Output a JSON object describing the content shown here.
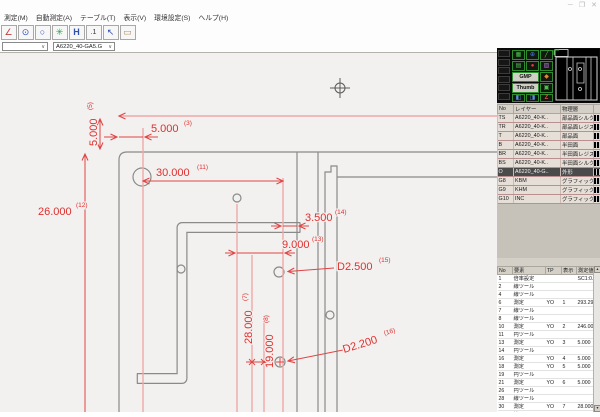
{
  "window": {
    "controls": [
      "─",
      "❐",
      "✕"
    ],
    "menu": [
      "測定(M)",
      "自動測定(A)",
      "テーブル(T)",
      "表示(V)",
      "環境設定(S)",
      "ヘルプ(H)"
    ]
  },
  "toolbar": {
    "icons": [
      {
        "name": "angle-measure-icon",
        "glyph": "∠"
      },
      {
        "name": "circle-pair-icon",
        "glyph": "⊙"
      },
      {
        "name": "circle-measure-icon",
        "glyph": "○"
      },
      {
        "name": "gear-icon",
        "glyph": "✳"
      },
      {
        "name": "horizontal-distance-icon",
        "glyph": "H"
      },
      {
        "name": "number-label-icon",
        "glyph": ".1"
      },
      {
        "name": "select-cursor-icon",
        "glyph": "↖"
      },
      {
        "name": "report-window-icon",
        "glyph": "▭"
      }
    ]
  },
  "combos": {
    "blank": "",
    "file": "A6220_40-GA5.G",
    "caret": "∨"
  },
  "drawing": {
    "dims": {
      "d3": {
        "value": "5.000",
        "idx": "(3)"
      },
      "d5": {
        "value": "5.000",
        "idx": "(5)"
      },
      "d7": {
        "value": "28.000",
        "idx": "(7)"
      },
      "d8": {
        "value": "19.000",
        "idx": "(8)"
      },
      "d11": {
        "value": "30.000",
        "idx": "(11)"
      },
      "d12": {
        "value": "26.000",
        "idx": "(12)"
      },
      "d13": {
        "value": "9.000",
        "idx": "(13)"
      },
      "d14": {
        "value": "3.500",
        "idx": "(14)"
      },
      "d15": {
        "value": "D2.500",
        "idx": "(15)"
      },
      "d16": {
        "value": "D2.200",
        "idx": "(16)"
      }
    },
    "colors": {
      "dimension": "#e02f2f",
      "extension": "#f0a8a8",
      "part": "#8a8a8a",
      "background": "#f2f1ef"
    }
  },
  "panel": {
    "buttons": {
      "gmp": "GMP",
      "thumb": "Thumb"
    },
    "cluster_icons": [
      {
        "name": "grid-icon",
        "glyph": "▦"
      },
      {
        "name": "target-icon",
        "glyph": "⊕"
      },
      {
        "name": "draw-icon",
        "glyph": "╱"
      },
      {
        "name": "doc-icon",
        "glyph": "▤"
      },
      {
        "name": "record-icon",
        "glyph": "●"
      },
      {
        "name": "palette-icon",
        "glyph": "▨"
      },
      {
        "name": "wrench-icon",
        "glyph": "◆"
      },
      {
        "name": "camera-icon",
        "glyph": "▣"
      },
      {
        "name": "up-icon",
        "glyph": "◧"
      },
      {
        "name": "down-icon",
        "glyph": "◨"
      },
      {
        "name": "zoom-icon",
        "glyph": "Z"
      }
    ],
    "layer_table": {
      "headers": [
        "No",
        "レイヤー",
        "物理層"
      ],
      "rows": [
        {
          "no": "TS",
          "layer": "A6220_40-K..",
          "phys": "部品面シルク"
        },
        {
          "no": "TR",
          "layer": "A6220_40-K..",
          "phys": "部品面レジスト"
        },
        {
          "no": "T",
          "layer": "A6220_40-K..",
          "phys": "部品面"
        },
        {
          "no": "B",
          "layer": "A6220_40-K..",
          "phys": "半田面"
        },
        {
          "no": "BR",
          "layer": "A6220_40-K..",
          "phys": "半田面レジスト"
        },
        {
          "no": "BS",
          "layer": "A6220_40-K..",
          "phys": "半田面シルク"
        },
        {
          "no": "O",
          "layer": "A6220_40-G..",
          "phys": "外形",
          "selected": true
        },
        {
          "no": "G8",
          "layer": "KBM",
          "phys": "グラフィック"
        },
        {
          "no": "G9",
          "layer": "KHM",
          "phys": "グラフィック"
        },
        {
          "no": "G10",
          "layer": "INC",
          "phys": "グラフィック"
        }
      ]
    },
    "meas_table": {
      "headers": [
        "No",
        "要素",
        "TP",
        "表示",
        "測定値"
      ],
      "scroll_up": "▲",
      "scroll_down": "▼",
      "rows": [
        {
          "no": "1",
          "elem": "倍率設定",
          "tp": "",
          "disp": "",
          "val": "SC1:0.75"
        },
        {
          "no": "2",
          "elem": "線ツール",
          "tp": "",
          "disp": "",
          "val": ""
        },
        {
          "no": "4",
          "elem": "線ツール",
          "tp": "",
          "disp": "",
          "val": ""
        },
        {
          "no": "6",
          "elem": "測定",
          "tp": "YO",
          "disp": "1",
          "val": "293.294"
        },
        {
          "no": "7",
          "elem": "線ツール",
          "tp": "",
          "disp": "",
          "val": ""
        },
        {
          "no": "8",
          "elem": "線ツール",
          "tp": "",
          "disp": "",
          "val": ""
        },
        {
          "no": "10",
          "elem": "測定",
          "tp": "YO",
          "disp": "2",
          "val": "246.000"
        },
        {
          "no": "11",
          "elem": "円ツール",
          "tp": "",
          "disp": "",
          "val": ""
        },
        {
          "no": "13",
          "elem": "測定",
          "tp": "YO",
          "disp": "3",
          "val": "5.000"
        },
        {
          "no": "14",
          "elem": "円ツール",
          "tp": "",
          "disp": "",
          "val": ""
        },
        {
          "no": "16",
          "elem": "測定",
          "tp": "YO",
          "disp": "4",
          "val": "5.000"
        },
        {
          "no": "18",
          "elem": "測定",
          "tp": "YO",
          "disp": "5",
          "val": "5.000"
        },
        {
          "no": "19",
          "elem": "円ツール",
          "tp": "",
          "disp": "",
          "val": ""
        },
        {
          "no": "21",
          "elem": "測定",
          "tp": "YO",
          "disp": "6",
          "val": "5.000"
        },
        {
          "no": "26",
          "elem": "円ツール",
          "tp": "",
          "disp": "",
          "val": ""
        },
        {
          "no": "28",
          "elem": "線ツール",
          "tp": "",
          "disp": "",
          "val": ""
        },
        {
          "no": "30",
          "elem": "測定",
          "tp": "YO",
          "disp": "7",
          "val": "28.000"
        },
        {
          "no": "31",
          "elem": "線ツール",
          "tp": "",
          "disp": "",
          "val": ""
        },
        {
          "no": "33",
          "elem": "測定",
          "tp": "YO",
          "disp": "8",
          "val": "19.000"
        }
      ]
    }
  }
}
